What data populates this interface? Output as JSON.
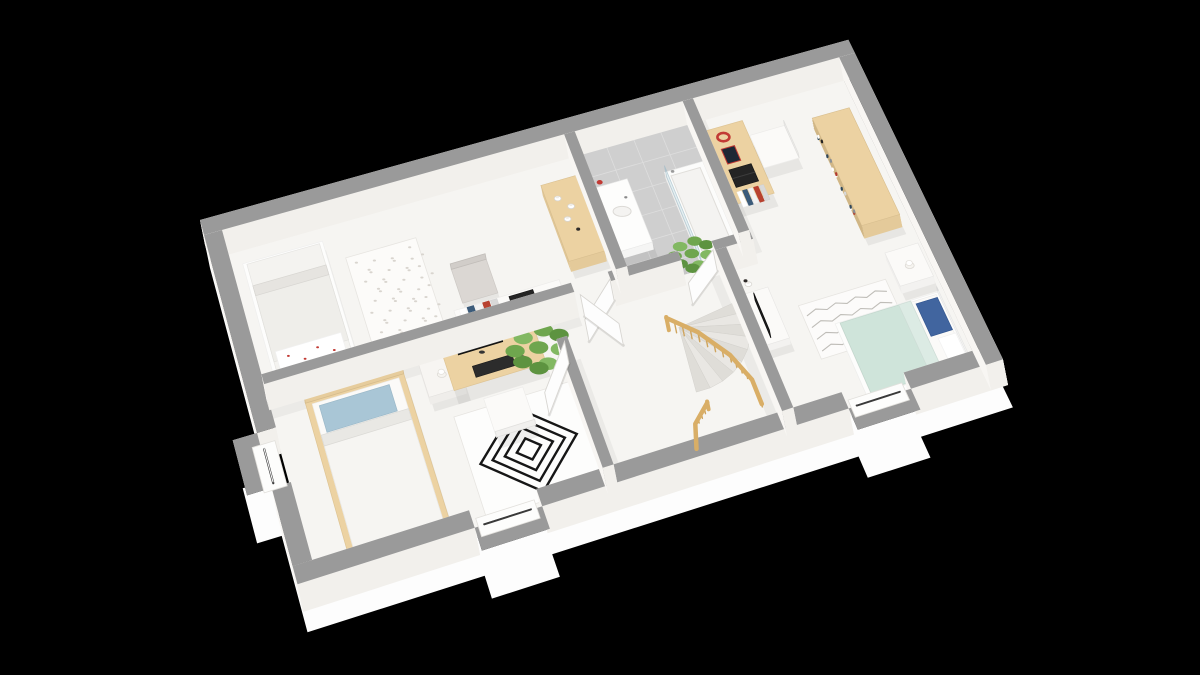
{
  "meta": {
    "canvas": {
      "w": 1200,
      "h": 675
    },
    "background": "#000000"
  },
  "palette": {
    "wallTop": "#9a9a9a",
    "wallFaceLight": "#f8f6f3",
    "wallFaceDark": "#efece8",
    "wallFaceSouth": "#f2f0ec",
    "floor": "#f6f5f2",
    "skirt": "#fdfdfd",
    "tile": "#cfcfcf",
    "tileLine": "#dedede",
    "wood": "#ecd2a2",
    "woodRail": "#d9ae66",
    "woodSpindle": "#cfa55f",
    "white": "#fbfaf8",
    "mint": "#cfe4da",
    "mintFold": "#dcebe4",
    "bluePillow": "#41659f",
    "lightBluePillow": "#a9c6d6",
    "rugLine": "#161616",
    "scribble": "#b4b1ac",
    "dark": "#1f1f1f",
    "red": "#c23a34",
    "green1": "#6fa64e",
    "green2": "#82b862",
    "green3": "#5d9340",
    "chairGray": "#dbd7d3",
    "shadow": "rgba(0,0,0,0.06)"
  },
  "plan": {
    "W": 9.7,
    "H": 5.5,
    "corners": {
      "nw": [
        205,
        245
      ],
      "ne": [
        853,
        63
      ],
      "se": [
        1008,
        385
      ],
      "sw": [
        303,
        612
      ]
    },
    "lift": [
      -5,
      -25
    ],
    "skirtOffset": [
      10,
      48
    ],
    "outline": [
      [
        0,
        0
      ],
      [
        0,
        3.35
      ],
      [
        -0.32,
        3.35
      ],
      [
        -0.32,
        4.15
      ],
      [
        0,
        4.15
      ],
      [
        0,
        5.5
      ],
      [
        2.3,
        5.5
      ],
      [
        2.3,
        5.82
      ],
      [
        3.2,
        5.82
      ],
      [
        3.2,
        5.5
      ],
      [
        7.45,
        5.5
      ],
      [
        7.45,
        5.82
      ],
      [
        8.35,
        5.82
      ],
      [
        8.35,
        5.5
      ],
      [
        9.7,
        5.5
      ],
      [
        9.7,
        0
      ]
    ],
    "floor": [
      0.25,
      0.25,
      9.2,
      5.0
    ],
    "walls": [
      {
        "name": "wall-outer-top",
        "r": [
          0,
          0,
          9.7,
          0.25
        ]
      },
      {
        "name": "wall-outer-left-upper",
        "r": [
          0,
          0.25,
          0.25,
          3.1
        ]
      },
      {
        "name": "wall-outer-left-lower",
        "r": [
          0,
          4.15,
          0.25,
          1.1
        ]
      },
      {
        "name": "wall-outer-bottom-west",
        "r": [
          0,
          5.25,
          2.3,
          0.25
        ]
      },
      {
        "name": "wall-outer-bottom-mid",
        "r": [
          3.2,
          5.25,
          4.25,
          0.25
        ]
      },
      {
        "name": "wall-outer-bottom-east",
        "r": [
          8.35,
          5.25,
          1.35,
          0.25
        ]
      },
      {
        "name": "wall-outer-right",
        "r": [
          9.45,
          0.25,
          0.25,
          5.25
        ]
      },
      {
        "name": "wall-bedrooms-divider",
        "r": [
          0.25,
          2.55,
          4.3,
          0.15
        ]
      },
      {
        "name": "wall-hall-bathroom",
        "r": [
          5.08,
          2.55,
          1.02,
          0.15
        ]
      },
      {
        "name": "wall-hall-bedroom3",
        "r": [
          6.6,
          2.55,
          0.56,
          0.15
        ]
      },
      {
        "name": "wall-bathroom-left",
        "r": [
          5.2,
          0.25,
          0.16,
          2.3
        ]
      },
      {
        "name": "wall-bathroom-right",
        "r": [
          7.0,
          0.25,
          0.16,
          2.3
        ]
      },
      {
        "name": "wall-stairs-right",
        "r": [
          6.6,
          2.7,
          0.16,
          2.55
        ]
      },
      {
        "name": "wall-bedroom2-right",
        "r": [
          4.1,
          3.3,
          0.15,
          1.95
        ]
      }
    ],
    "wallShadows": [
      [
        0.25,
        2.7,
        4.3,
        0.14
      ],
      [
        5.36,
        2.4,
        1.64,
        0.14
      ],
      [
        4.25,
        3.3,
        0.12,
        1.95
      ],
      [
        6.45,
        2.7,
        0.14,
        2.55
      ],
      [
        7.16,
        0.25,
        0.12,
        2.3
      ]
    ],
    "bays": [
      {
        "name": "window-bay-left",
        "r": [
          -0.32,
          3.35,
          0.32,
          0.8
        ],
        "sill": [
          -0.1,
          3.42,
          0.3,
          0.66
        ],
        "slit": [
          [
            0.04,
            3.5
          ],
          [
            0.04,
            4.0
          ]
        ]
      },
      {
        "name": "window-bay-bottom-left",
        "r": [
          2.3,
          5.5,
          0.9,
          0.32
        ],
        "sill": [
          2.36,
          5.28,
          0.78,
          0.26
        ],
        "slit": [
          [
            2.44,
            5.4
          ],
          [
            3.06,
            5.4
          ]
        ]
      },
      {
        "name": "window-bay-bottom-right",
        "r": [
          7.45,
          5.5,
          0.9,
          0.32
        ],
        "sill": [
          7.51,
          5.28,
          0.78,
          0.26
        ],
        "slit": [
          [
            7.59,
            5.4
          ],
          [
            8.21,
            5.4
          ]
        ]
      }
    ],
    "doors": [
      {
        "name": "door-bedroom1",
        "a": [
          5.08,
          2.62
        ],
        "b": [
          4.56,
          3.1
        ]
      },
      {
        "name": "door-bathroom",
        "a": [
          4.62,
          2.72
        ],
        "b": [
          4.98,
          3.3
        ]
      },
      {
        "name": "door-bedroom2",
        "a": [
          4.2,
          3.32
        ],
        "b": [
          3.72,
          3.95
        ]
      },
      {
        "name": "door-bedroom3",
        "a": [
          6.58,
          2.64
        ],
        "b": [
          6.08,
          3.02
        ]
      }
    ],
    "stairs": {
      "name": "staircase",
      "pivot": [
        5.78,
        3.3
      ],
      "r": 0.98,
      "a0": -8,
      "a1": 96,
      "steps": 9
    },
    "railings": [
      {
        "name": "stair-railing-outer",
        "pts": [
          [
            5.64,
            3.28,
            0.5
          ],
          [
            5.98,
            3.58,
            0.4
          ],
          [
            6.28,
            4.0,
            0.3
          ],
          [
            6.44,
            4.4,
            0.2
          ],
          [
            6.44,
            4.75,
            0.14
          ]
        ]
      },
      {
        "name": "stair-railing-inner",
        "pts": [
          [
            5.75,
            4.55,
            0.28
          ],
          [
            5.5,
            4.75,
            0.18
          ],
          [
            5.4,
            5.05,
            0.08
          ]
        ]
      }
    ],
    "tiles": {
      "name": "bathroom-floor",
      "r": [
        5.36,
        0.25,
        1.64,
        2.3
      ],
      "step": 0.41
    },
    "rugs": [
      {
        "name": "rug-floral-bedroom1",
        "style": "dots",
        "r": [
          1.78,
          0.82,
          1.0,
          1.38
        ],
        "fill": "#fcfbf9",
        "line": "#d9d5cf"
      },
      {
        "name": "rug-geometric-bedroom2",
        "style": "geo",
        "r": [
          2.52,
          3.58,
          1.6,
          1.5
        ],
        "fill": "#fdfdfc",
        "line": "#161616"
      },
      {
        "name": "rug-scribble-bedroom3",
        "style": "scribble",
        "r": [
          7.45,
          3.5,
          1.3,
          0.85
        ],
        "fill": "#fcfbfa",
        "line": "#b4b1ac"
      }
    ],
    "furniture": [
      {
        "kind": "bed",
        "name": "bed-bedroom1",
        "frame": [
          0.42,
          0.5,
          1.12,
          1.95
        ],
        "frameFill": "#fdfdfc",
        "mattress": [
          0.47,
          0.55,
          1.02,
          1.85
        ],
        "mattressFill": "#f4f3f0",
        "duvet": [
          0.47,
          0.92,
          1.02,
          1.2
        ],
        "duvetFill": "#efeeea",
        "fold": [
          0.47,
          0.92,
          1.02,
          0.16
        ],
        "foldFill": "#e6e4e0",
        "pillows": [
          {
            "r": [
              0.52,
              2.0,
              0.9,
              0.34
            ],
            "fill": "#ffffff",
            "accent": "#c23a34"
          }
        ]
      },
      {
        "kind": "chair",
        "name": "chair-bedroom1",
        "r": [
          3.1,
          1.52,
          0.5,
          0.55
        ],
        "fill": "#dbd7d3",
        "back": "n"
      },
      {
        "kind": "desk",
        "name": "wall-desk-bedroom1",
        "r": [
          2.95,
          2.18,
          1.5,
          0.36
        ],
        "fill": "#fbfaf8",
        "items": [
          {
            "type": "laptop",
            "r": [
              3.72,
              2.22,
              0.34,
              0.26
            ]
          },
          {
            "type": "books",
            "r": [
              3.02,
              2.2,
              0.55,
              0.28
            ]
          }
        ]
      },
      {
        "kind": "box",
        "name": "dresser-bedroom1",
        "r": [
          4.66,
          0.72,
          0.52,
          1.28
        ],
        "t": 0.42,
        "fill": "#ecd2a2"
      },
      {
        "kind": "jars",
        "name": "dresser-jars",
        "t": 0.43,
        "items": [
          [
            4.82,
            1.0
          ],
          [
            4.96,
            1.18
          ],
          [
            4.85,
            1.36
          ]
        ],
        "darkItem": [
          4.94,
          1.56
        ]
      },
      {
        "kind": "sink",
        "name": "bathroom-sink",
        "r": [
          5.38,
          0.95,
          0.48,
          1.08
        ]
      },
      {
        "kind": "dot",
        "name": "cosmetics-red",
        "c": [
          5.47,
          0.9
        ],
        "t": 0.34,
        "fill": "#c23a34",
        "radPx": 3
      },
      {
        "kind": "tub",
        "name": "shower-bathtub",
        "r": [
          6.4,
          1.0,
          0.58,
          1.45
        ]
      },
      {
        "kind": "bed",
        "name": "bed-bedroom2",
        "frame": [
          0.72,
          2.78,
          1.34,
          2.3
        ],
        "frameFill": "#ecd2a2",
        "headboard": "n",
        "footboard": "s",
        "mattress": [
          0.8,
          2.86,
          1.18,
          2.14
        ],
        "mattressFill": "#fbfaf8",
        "duvet": [
          0.8,
          3.35,
          1.18,
          1.62
        ],
        "duvetFill": "#f6f5f2",
        "fold": [
          0.8,
          3.35,
          1.18,
          0.16
        ],
        "foldFill": "#e9e8e4",
        "pillows": [
          {
            "r": [
              0.88,
              2.95,
              0.95,
              0.4
            ],
            "fill": "#a9c6d6"
          }
        ]
      },
      {
        "kind": "box",
        "name": "nightstand-bedroom2",
        "r": [
          2.28,
          2.8,
          0.5,
          0.5
        ],
        "t": 0.28,
        "fill": "#f7f5f2"
      },
      {
        "kind": "lamp",
        "name": "lamp-bedroom2",
        "c": [
          2.53,
          3.04
        ],
        "t": 0.3
      },
      {
        "kind": "desk",
        "name": "desk-bedroom2",
        "r": [
          2.62,
          2.74,
          1.28,
          0.58
        ],
        "fill": "#ecd2a2",
        "items": [
          {
            "type": "monitor",
            "a": [
              2.82,
              2.84
            ],
            "b": [
              3.44,
              2.84
            ]
          },
          {
            "type": "keyboard",
            "r": [
              2.95,
              3.06,
              0.55,
              0.17
            ]
          },
          {
            "type": "mouse",
            "c": [
              3.62,
              3.14
            ]
          }
        ]
      },
      {
        "kind": "chair",
        "name": "chair-bedroom2",
        "r": [
          2.96,
          3.52,
          0.54,
          0.58
        ],
        "fill": "#fbfaf8",
        "back": "s"
      },
      {
        "kind": "desk",
        "name": "desk-bedroom3",
        "r": [
          7.18,
          0.55,
          0.58,
          1.28
        ],
        "fill": "#ecd2a2",
        "items": [
          {
            "type": "headphones",
            "c": [
              7.4,
              0.74
            ]
          },
          {
            "type": "tablet",
            "r": [
              7.3,
              0.92,
              0.2,
              0.26
            ]
          },
          {
            "type": "laptop",
            "r": [
              7.28,
              1.28,
              0.34,
              0.3
            ]
          },
          {
            "type": "books",
            "r": [
              7.26,
              1.66,
              0.42,
              0.26
            ]
          }
        ]
      },
      {
        "kind": "chair",
        "name": "chair-bedroom3",
        "r": [
          7.78,
          0.78,
          0.54,
          0.58
        ],
        "fill": "#fbfaf8",
        "back": "e"
      },
      {
        "kind": "bookshelf",
        "name": "bookshelf-bedroom3",
        "r": [
          8.72,
          0.92,
          0.58,
          1.88
        ],
        "t": 0.52,
        "fill": "#ecd2a2"
      },
      {
        "kind": "box",
        "name": "tv-stand-bedroom3",
        "r": [
          6.8,
          3.18,
          0.34,
          0.82
        ],
        "t": 0.25,
        "fill": "#fbfaf8"
      },
      {
        "kind": "panel",
        "name": "tv-screen",
        "a": [
          6.9,
          3.32
        ],
        "b": [
          6.9,
          3.92
        ],
        "t0": 0.25,
        "t1": 0.56,
        "fill": "#1f1f1f"
      },
      {
        "kind": "jars",
        "name": "tv-stand-items",
        "t": 0.27,
        "items": [
          [
            6.9,
            3.06
          ]
        ],
        "darkItem": [
          6.88,
          3.0
        ]
      },
      {
        "kind": "bed",
        "name": "bed-bedroom3",
        "frame": [
          7.82,
          3.95,
          1.55,
          1.22
        ],
        "frameFill": "#fdfdfc",
        "headboard": "e",
        "mattress": [
          7.88,
          4.0,
          1.43,
          1.12
        ],
        "mattressFill": "#fbfaf8",
        "duvet": [
          7.88,
          4.0,
          1.05,
          1.12
        ],
        "duvetFill": "#cfe4da",
        "fold": [
          8.75,
          4.0,
          0.18,
          1.12
        ],
        "foldFill": "#dcebe4",
        "pillows": [
          {
            "r": [
              8.98,
              4.08,
              0.32,
              0.52
            ],
            "fill": "#41659f"
          },
          {
            "r": [
              9.06,
              4.66,
              0.26,
              0.44
            ],
            "fill": "#ffffff"
          }
        ]
      },
      {
        "kind": "box",
        "name": "nightstand-bedroom3",
        "r": [
          8.88,
          3.22,
          0.5,
          0.55
        ],
        "t": 0.3,
        "fill": "#fbfaf8"
      },
      {
        "kind": "lamp",
        "name": "lamp-bedroom3",
        "c": [
          9.13,
          3.52
        ],
        "t": 0.32
      },
      {
        "kind": "plant",
        "name": "plant-bathroom",
        "c": [
          6.33,
          2.32
        ],
        "rad": 0.28
      },
      {
        "kind": "plant",
        "name": "plant-bedroom2",
        "c": [
          3.88,
          3.02
        ],
        "rad": 0.37
      }
    ]
  }
}
